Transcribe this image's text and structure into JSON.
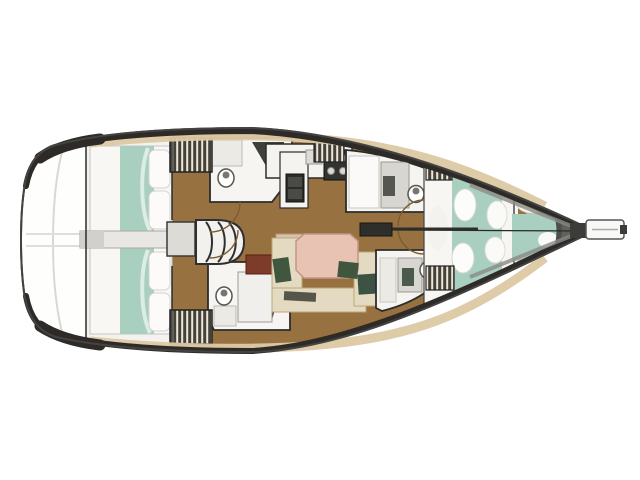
{
  "figure": {
    "type": "yacht-deck-floor-plan",
    "orientation": "bow-right",
    "background": "#ffffff"
  },
  "palette": {
    "hull_line": "#434341",
    "bulwark_dark": "#2d2a27",
    "deck_tan": "#dcc9a4",
    "floor_brown": "#97713f",
    "cabin_white": "#f4f2ee",
    "bed_white": "#f8f7f4",
    "bed_teal": "#a9cfc1",
    "pillow_white": "#fcfbf9",
    "head_white": "#f6f5f1",
    "shower_gray": "#d7d6d1",
    "settee_beige": "#e4dac1",
    "table_salmon": "#e8c2b2",
    "cushion_green": "#41563f",
    "locker_maroon": "#7d3b2a",
    "appliance_dark": "#2b2b29",
    "hatch_dark": "#454038",
    "hatch_light": "#ece7da",
    "bow_shadow": "#4e4e4a",
    "engine_box": "#e9e7e3",
    "door_arc": "#7b5c31"
  },
  "rooms": [
    {
      "id": "swim-platform",
      "side": "stern"
    },
    {
      "id": "aft-cabin-port",
      "feature": "double-berth"
    },
    {
      "id": "aft-cabin-starboard",
      "feature": "double-berth"
    },
    {
      "id": "aft-head-port",
      "feature": "toilet-sink"
    },
    {
      "id": "aft-head-starboard",
      "feature": "toilet-sink"
    },
    {
      "id": "companionway-stairs",
      "feature": "steps"
    },
    {
      "id": "galley",
      "feature": "stove-sink-oven"
    },
    {
      "id": "salon",
      "feature": "u-settee-table"
    },
    {
      "id": "forward-head-port",
      "feature": "toilet-shower"
    },
    {
      "id": "forward-head-starboard",
      "feature": "toilet-shower"
    },
    {
      "id": "forward-cabin",
      "feature": "v-berth"
    },
    {
      "id": "forepeak",
      "feature": "berth"
    },
    {
      "id": "bowsprit",
      "side": "bow"
    }
  ]
}
